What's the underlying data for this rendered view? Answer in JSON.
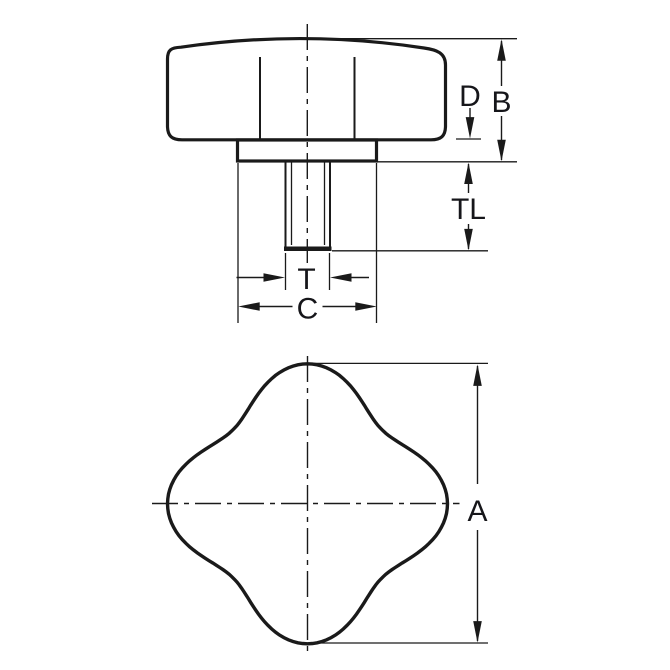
{
  "diagram": {
    "background_color": "#ffffff",
    "line_color": "#1a1a1a",
    "label_color": "#16161a",
    "views": {
      "front_view": {
        "dimension_labels": {
          "D": "D",
          "B": "B",
          "TL": "TL",
          "T": "T",
          "C": "C"
        }
      },
      "plan_view": {
        "dimension_labels": {
          "A": "A"
        }
      }
    }
  }
}
